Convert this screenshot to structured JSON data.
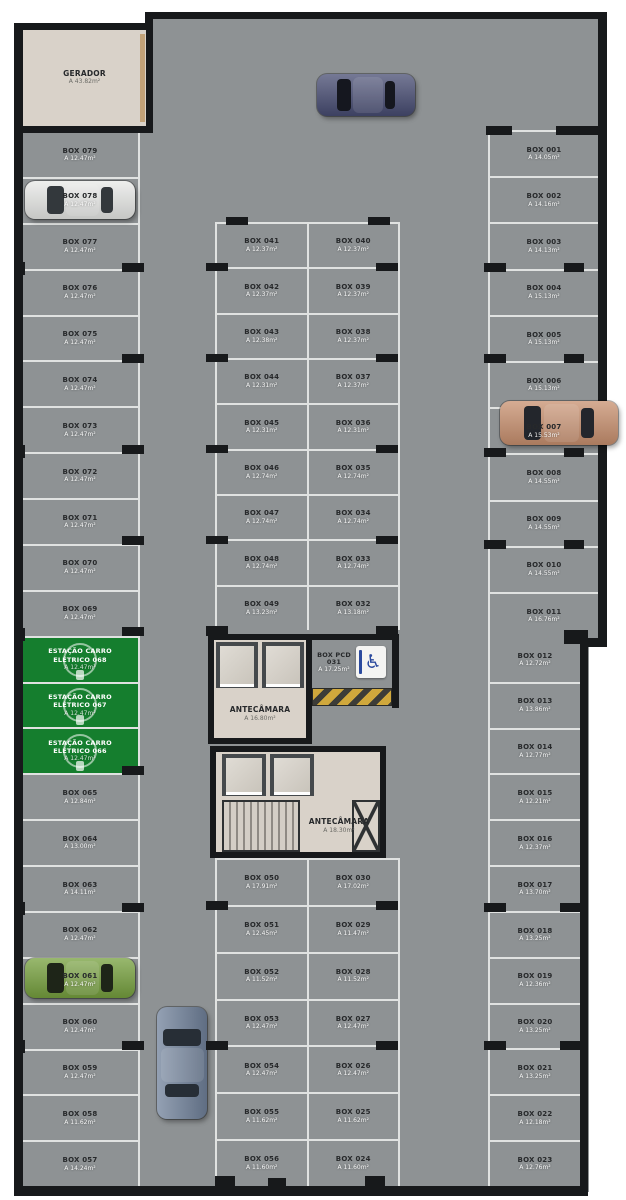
{
  "colors": {
    "floor": "#8e9294",
    "stall_line": "#e0e2e1",
    "wall": "#17191b",
    "ev_green": "#157e2e",
    "room_beige": "#d9d2c9",
    "hatch_yellow": "#d0a83c",
    "sign_blue": "#2b4a9e"
  },
  "rooms": {
    "gerador": {
      "label": "GERADOR",
      "area": "A  43.82m²"
    },
    "antecamara_upper": {
      "label": "ANTECÂMARA",
      "area": "A  16.80m²"
    },
    "antecamara_lower": {
      "label": "ANTECÂMARA",
      "area": "A  18.30m²"
    },
    "box_pcd": {
      "label": "BOX PCD 031",
      "area": "A  17.25m²"
    }
  },
  "icons": {
    "wheelchair": "♿",
    "ev_plug": "ev-plug-icon"
  },
  "stalls": {
    "left": [
      {
        "label": "BOX 079",
        "area": "A 12.47m²"
      },
      {
        "label": "BOX 078",
        "area": "A 12.47m²"
      },
      {
        "label": "BOX 077",
        "area": "A 12.47m²"
      },
      {
        "label": "BOX 076",
        "area": "A 12.47m²"
      },
      {
        "label": "BOX 075",
        "area": "A 12.47m²"
      },
      {
        "label": "BOX 074",
        "area": "A 12.47m²"
      },
      {
        "label": "BOX 073",
        "area": "A 12.47m²"
      },
      {
        "label": "BOX 072",
        "area": "A 12.47m²"
      },
      {
        "label": "BOX 071",
        "area": "A 12.47m²"
      },
      {
        "label": "BOX 070",
        "area": "A 12.47m²"
      },
      {
        "label": "BOX 069",
        "area": "A 12.47m²"
      },
      {
        "type": "ev",
        "line1": "ESTAÇÃO CARRO",
        "line2": "ELÉTRICO 068",
        "area": "A 12.47m²"
      },
      {
        "type": "ev",
        "line1": "ESTAÇÃO CARRO",
        "line2": "ELÉTRICO 067",
        "area": "A 12.47m²"
      },
      {
        "type": "ev",
        "line1": "ESTAÇÃO CARRO",
        "line2": "ELÉTRICO 066",
        "area": "A 12.47m²"
      },
      {
        "label": "BOX 065",
        "area": "A 12.84m²"
      },
      {
        "label": "BOX 064",
        "area": "A 13.00m²"
      },
      {
        "label": "BOX 063",
        "area": "A 14.11m²"
      },
      {
        "label": "BOX 062",
        "area": "A 12.47m²"
      },
      {
        "label": "BOX 061",
        "area": "A 12.47m²"
      },
      {
        "label": "BOX 060",
        "area": "A 12.47m²"
      },
      {
        "label": "BOX 059",
        "area": "A 12.47m²"
      },
      {
        "label": "BOX 058",
        "area": "A 11.62m²"
      },
      {
        "label": "BOX 057",
        "area": "A 14.24m²"
      }
    ],
    "middle_top_left": [
      {
        "label": "BOX 041",
        "area": "A 12.37m²"
      },
      {
        "label": "BOX 042",
        "area": "A 12.37m²"
      },
      {
        "label": "BOX 043",
        "area": "A 12.38m²"
      },
      {
        "label": "BOX 044",
        "area": "A 12.31m²"
      },
      {
        "label": "BOX 045",
        "area": "A 12.31m²"
      },
      {
        "label": "BOX 046",
        "area": "A 12.74m²"
      },
      {
        "label": "BOX 047",
        "area": "A 12.74m²"
      },
      {
        "label": "BOX 048",
        "area": "A 12.74m²"
      },
      {
        "label": "BOX 049",
        "area": "A 13.23m²"
      }
    ],
    "middle_top_right": [
      {
        "label": "BOX 040",
        "area": "A 12.37m²"
      },
      {
        "label": "BOX 039",
        "area": "A 12.37m²"
      },
      {
        "label": "BOX 038",
        "area": "A 12.37m²"
      },
      {
        "label": "BOX 037",
        "area": "A 12.37m²"
      },
      {
        "label": "BOX 036",
        "area": "A 12.31m²"
      },
      {
        "label": "BOX 035",
        "area": "A 12.74m²"
      },
      {
        "label": "BOX 034",
        "area": "A 12.74m²"
      },
      {
        "label": "BOX 033",
        "area": "A 12.74m²"
      },
      {
        "label": "BOX 032",
        "area": "A 13.18m²"
      }
    ],
    "middle_bottom_left": [
      {
        "label": "BOX 050",
        "area": "A 17.91m²"
      },
      {
        "label": "BOX 051",
        "area": "A 12.45m²"
      },
      {
        "label": "BOX 052",
        "area": "A 11.52m²"
      },
      {
        "label": "BOX 053",
        "area": "A 12.47m²"
      },
      {
        "label": "BOX 054",
        "area": "A 12.47m²"
      },
      {
        "label": "BOX 055",
        "area": "A 11.62m²"
      },
      {
        "label": "BOX 056",
        "area": "A 11.60m²"
      }
    ],
    "middle_bottom_right": [
      {
        "label": "BOX 030",
        "area": "A 17.02m²"
      },
      {
        "label": "BOX 029",
        "area": "A 11.47m²"
      },
      {
        "label": "BOX 028",
        "area": "A 11.52m²"
      },
      {
        "label": "BOX 027",
        "area": "A 12.47m²"
      },
      {
        "label": "BOX 026",
        "area": "A 12.47m²"
      },
      {
        "label": "BOX 025",
        "area": "A 11.62m²"
      },
      {
        "label": "BOX 024",
        "area": "A 11.60m²"
      }
    ],
    "right_upper": [
      {
        "label": "BOX 001",
        "area": "A 14.05m²"
      },
      {
        "label": "BOX 002",
        "area": "A 14.16m²"
      },
      {
        "label": "BOX 003",
        "area": "A 14.13m²"
      },
      {
        "label": "BOX 004",
        "area": "A 15.13m²"
      },
      {
        "label": "BOX 005",
        "area": "A 15.13m²"
      },
      {
        "label": "BOX 006",
        "area": "A 15.13m²"
      },
      {
        "label": "BOX 007",
        "area": "A 15.53m²"
      },
      {
        "label": "BOX 008",
        "area": "A 14.55m²"
      },
      {
        "label": "BOX 009",
        "area": "A 14.55m²"
      },
      {
        "label": "BOX 010",
        "area": "A 14.55m²"
      },
      {
        "label": "BOX 011",
        "area": "A 16.76m²"
      }
    ],
    "right_lower": [
      {
        "label": "BOX 012",
        "area": "A 12.72m²"
      },
      {
        "label": "BOX 013",
        "area": "A 13.86m²"
      },
      {
        "label": "BOX 014",
        "area": "A 12.77m²"
      },
      {
        "label": "BOX 015",
        "area": "A 12.21m²"
      },
      {
        "label": "BOX 016",
        "area": "A 12.37m²"
      },
      {
        "label": "BOX 017",
        "area": "A 13.70m²"
      },
      {
        "label": "BOX 018",
        "area": "A 13.25m²"
      },
      {
        "label": "BOX 019",
        "area": "A 12.36m²"
      },
      {
        "label": "BOX 020",
        "area": "A 13.25m²"
      },
      {
        "label": "BOX 021",
        "area": "A 13.25m²"
      },
      {
        "label": "BOX 022",
        "area": "A 12.18m²"
      },
      {
        "label": "BOX 023",
        "area": "A 12.76m²"
      }
    ]
  },
  "cars": [
    {
      "id": "car-white",
      "description": "white sedan",
      "body": "#e8e9e7",
      "glass": "#33383c",
      "location": "BOX 078"
    },
    {
      "id": "car-navy",
      "description": "dark blue car",
      "body": "#474c72",
      "glass": "#15171f",
      "location": "top aisle"
    },
    {
      "id": "car-copper",
      "description": "copper sedan",
      "body": "#c8906f",
      "glass": "#23262c",
      "location": "BOX 007"
    },
    {
      "id": "car-green",
      "description": "green hatchback",
      "body": "#76a03e",
      "glass": "#1e2518",
      "location": "BOX 061"
    },
    {
      "id": "car-steel",
      "description": "steel blue coupe",
      "body": "#70819a",
      "glass": "#272e36",
      "location": "center aisle"
    }
  ]
}
